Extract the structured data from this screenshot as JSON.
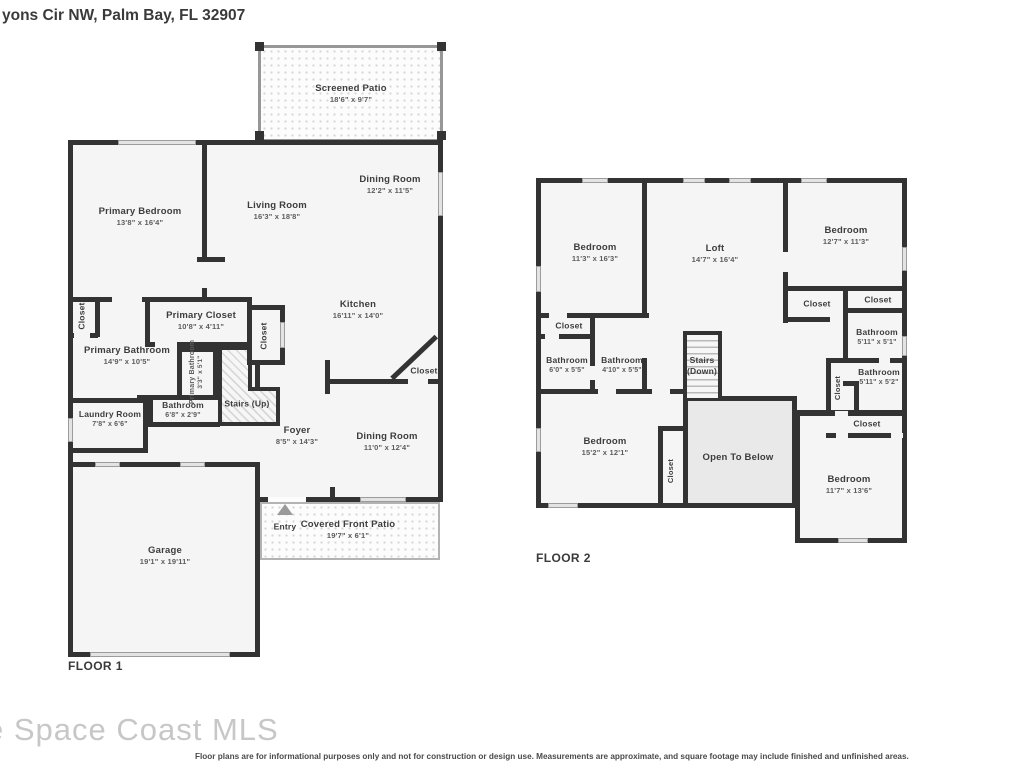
{
  "title": "yons Cir NW, Palm Bay, FL 32907",
  "watermark": "e Space Coast MLS",
  "disclaimer": "Floor plans are for informational purposes only and not for construction or design use. Measurements are approximate, and square footage may include finished and unfinished areas.",
  "floor1": {
    "label": "FLOOR 1",
    "rooms": {
      "screened_patio": {
        "name": "Screened Patio",
        "dims": "18'6\" x 9'7\""
      },
      "primary_bedroom": {
        "name": "Primary Bedroom",
        "dims": "13'8\" x 16'4\""
      },
      "living_room": {
        "name": "Living Room",
        "dims": "16'3\" x 18'8\""
      },
      "dining_room_upper": {
        "name": "Dining Room",
        "dims": "12'2\" x 11'5\""
      },
      "kitchen": {
        "name": "Kitchen",
        "dims": "16'11\" x 14'0\""
      },
      "primary_closet": {
        "name": "Primary Closet",
        "dims": "10'8\" x 4'11\""
      },
      "closet_nw": {
        "name": "Closet"
      },
      "primary_bathroom": {
        "name": "Primary Bathroom",
        "dims": "14'9\" x 10'5\""
      },
      "primary_bathroom_small": {
        "name": "Primary Bathroom",
        "dims": "3'3\" x 5'1\""
      },
      "closet_hall": {
        "name": "Closet"
      },
      "stairs_up": {
        "name": "Stairs (Up)"
      },
      "bathroom": {
        "name": "Bathroom",
        "dims": "6'8\" x 2'9\""
      },
      "laundry_room": {
        "name": "Laundry Room",
        "dims": "7'8\" x 6'6\""
      },
      "foyer": {
        "name": "Foyer",
        "dims": "8'5\" x 14'3\""
      },
      "dining_room_lower": {
        "name": "Dining Room",
        "dims": "11'0\" x 12'4\""
      },
      "closet_dining": {
        "name": "Closet"
      },
      "entry": {
        "name": "Entry"
      },
      "covered_front_patio": {
        "name": "Covered Front Patio",
        "dims": "19'7\" x 6'1\""
      },
      "garage": {
        "name": "Garage",
        "dims": "19'1\" x 19'11\""
      }
    }
  },
  "floor2": {
    "label": "FLOOR 2",
    "rooms": {
      "bedroom_nw": {
        "name": "Bedroom",
        "dims": "11'3\" x 16'3\""
      },
      "loft": {
        "name": "Loft",
        "dims": "14'7\" x 16'4\""
      },
      "bedroom_ne": {
        "name": "Bedroom",
        "dims": "12'7\" x 11'3\""
      },
      "closet_w": {
        "name": "Closet"
      },
      "bathroom_w1": {
        "name": "Bathroom",
        "dims": "6'0\" x 5'5\""
      },
      "bathroom_w2": {
        "name": "Bathroom",
        "dims": "4'10\" x 5'5\""
      },
      "stairs_down": {
        "name": "Stairs",
        "sub": "(Down)"
      },
      "closet_mid": {
        "name": "Closet"
      },
      "closet_ne": {
        "name": "Closet"
      },
      "bathroom_e1": {
        "name": "Bathroom",
        "dims": "5'11\" x 5'1\""
      },
      "bathroom_e2": {
        "name": "Bathroom",
        "dims": "5'11\" x 5'2\""
      },
      "closet_e_v": {
        "name": "Closet"
      },
      "closet_e_h": {
        "name": "Closet"
      },
      "bedroom_sw": {
        "name": "Bedroom",
        "dims": "15'2\" x 12'1\""
      },
      "closet_sw_v": {
        "name": "Closet"
      },
      "open_to_below": {
        "name": "Open To Below"
      },
      "bedroom_se": {
        "name": "Bedroom",
        "dims": "11'7\" x 13'6\""
      }
    }
  },
  "colors": {
    "wall": "#333333",
    "room_fill": "#f5f5f5",
    "open_to_below_fill": "#e9e9e9"
  }
}
